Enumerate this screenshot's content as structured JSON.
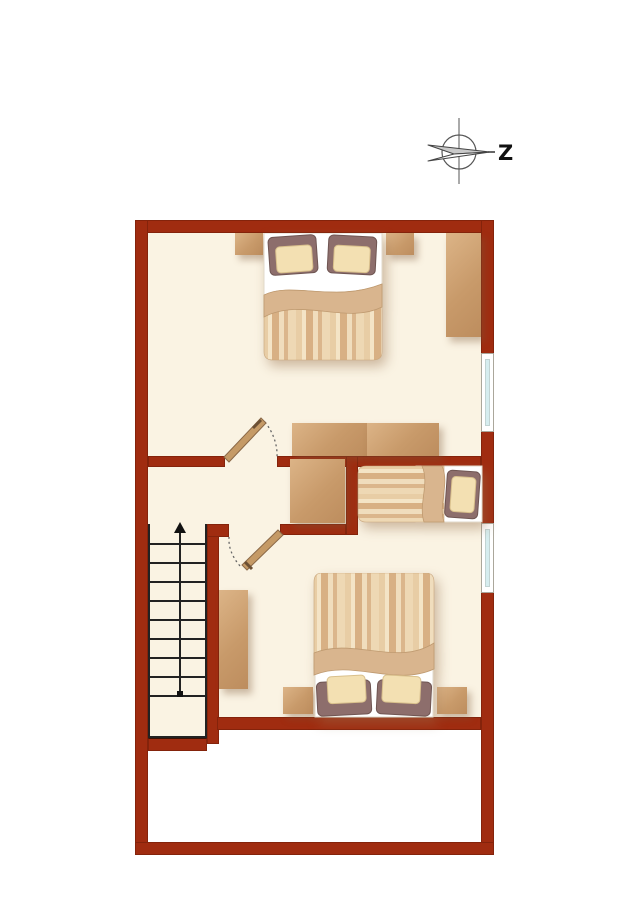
{
  "title": "upper-floor-plan",
  "compass": {
    "label": "Z"
  },
  "palette": {
    "wall": "#A02C10",
    "floor": "#FAF3E3",
    "void": "#FFFFFF",
    "wood_light": "#DCB487",
    "wood": "#C89A6A",
    "window_glass": "#D6EDEF",
    "duvet_fold": "#D9B58E",
    "pillow_outer": "#8D6E6C",
    "pillow_inner": "#F3E0B2",
    "stair_line": "#222222"
  },
  "rooms": [
    {
      "name": "bedroom-top"
    },
    {
      "name": "hallway-landing"
    },
    {
      "name": "bedroom-bottom"
    },
    {
      "name": "stairwell"
    },
    {
      "name": "void-space"
    }
  ],
  "windows": [
    {
      "name": "window-upper-right"
    },
    {
      "name": "window-lower-right"
    }
  ],
  "doors": [
    {
      "name": "door-upper-bedroom"
    },
    {
      "name": "door-lower-bedroom"
    }
  ],
  "stairs": {
    "treads": 9,
    "direction": "up"
  },
  "furniture": [
    {
      "name": "double-bed-top"
    },
    {
      "name": "nightstand-top-left"
    },
    {
      "name": "nightstand-top-right"
    },
    {
      "name": "wardrobe-right"
    },
    {
      "name": "dresser-pair-left"
    },
    {
      "name": "dresser-pair-right"
    },
    {
      "name": "hall-dresser"
    },
    {
      "name": "single-bed"
    },
    {
      "name": "desk-shelf"
    },
    {
      "name": "double-bed-bottom"
    },
    {
      "name": "nightstand-bottom-left"
    },
    {
      "name": "nightstand-bottom-right"
    }
  ]
}
